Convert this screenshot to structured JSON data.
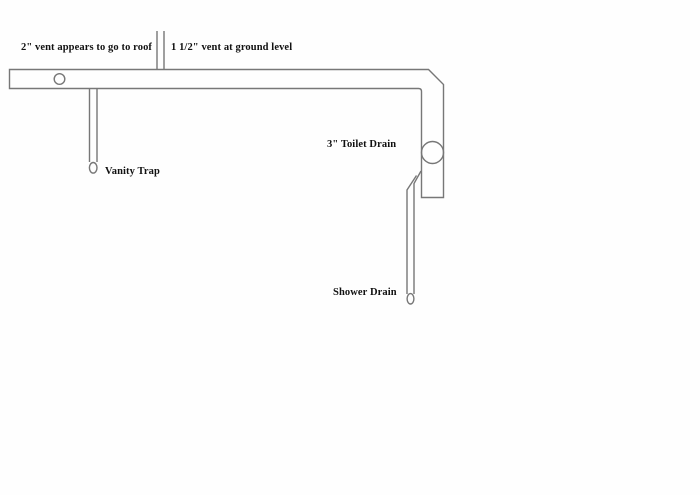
{
  "diagram": {
    "type": "plumbing-drain-vent-sketch",
    "background_color": "#fefefe",
    "line_color": "#777777",
    "text_color": "#111111"
  },
  "labels": {
    "vent_roof": "2\" vent appears to go to roof",
    "vent_ground": "1 1/2\" vent at ground level",
    "toilet_drain": "3\" Toilet Drain",
    "vanity_trap": "Vanity Trap",
    "shower_drain": "Shower Drain"
  }
}
